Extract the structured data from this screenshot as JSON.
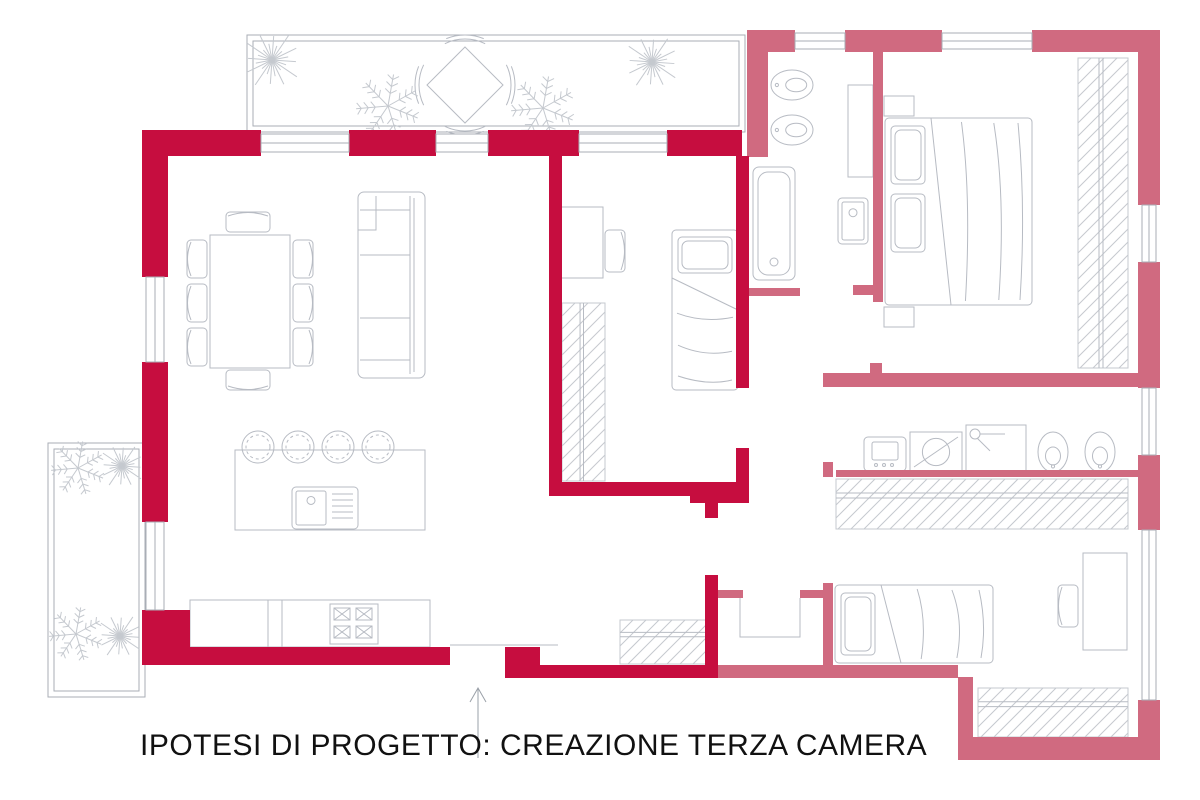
{
  "title": {
    "text": "IPOTESI DI PROGETTO: CREAZIONE TERZA CAMERA"
  },
  "legend": {
    "new_walls_color": "#C60D3F",
    "existing_walls_color": "#D06A80",
    "furniture_line_color": "#B7BBC3",
    "hatch_line_color": "#C5C9CF",
    "terrace_outline_color": "#A9AEB6",
    "entry_arrow_color": "#9AA0A8",
    "new_walls_meaning": "nuove pareti (terza camera)",
    "existing_walls_meaning": "pareti esistenti"
  },
  "canvas": {
    "width": 1200,
    "height": 800
  },
  "plan": {
    "walls_new": [
      {
        "n": "top-wall-seg-1",
        "x": 142,
        "y": 130,
        "w": 119,
        "h": 26
      },
      {
        "n": "top-wall-seg-2",
        "x": 349,
        "y": 130,
        "w": 87,
        "h": 26
      },
      {
        "n": "top-wall-seg-3",
        "x": 488,
        "y": 130,
        "w": 91,
        "h": 26
      },
      {
        "n": "top-wall-seg-4",
        "x": 667,
        "y": 130,
        "w": 75,
        "h": 26
      },
      {
        "n": "left-wall-seg-1",
        "x": 142,
        "y": 156,
        "w": 26,
        "h": 121
      },
      {
        "n": "left-wall-seg-2",
        "x": 142,
        "y": 362,
        "w": 26,
        "h": 160
      },
      {
        "n": "left-wall-corner",
        "x": 142,
        "y": 610,
        "w": 48,
        "h": 55
      },
      {
        "n": "bottom-wall-west",
        "x": 142,
        "y": 647,
        "w": 308,
        "h": 18
      },
      {
        "n": "entry-step",
        "x": 505,
        "y": 647,
        "w": 35,
        "h": 18
      },
      {
        "n": "bottom-wall-east",
        "x": 505,
        "y": 665,
        "w": 212,
        "h": 13
      },
      {
        "n": "new-bedroom-west-wall",
        "x": 549,
        "y": 156,
        "w": 13,
        "h": 326
      },
      {
        "n": "new-bedroom-south-wall",
        "x": 549,
        "y": 482,
        "w": 200,
        "h": 14
      },
      {
        "n": "new-bedroom-south-corner",
        "x": 690,
        "y": 482,
        "w": 59,
        "h": 21
      },
      {
        "n": "new-bedroom-east-wall-upper",
        "x": 736,
        "y": 156,
        "w": 13,
        "h": 232
      },
      {
        "n": "new-bedroom-east-wall-lower",
        "x": 736,
        "y": 448,
        "w": 13,
        "h": 34
      },
      {
        "n": "hall-wall-upper",
        "x": 705,
        "y": 495,
        "w": 13,
        "h": 23
      },
      {
        "n": "hall-wall-lower",
        "x": 705,
        "y": 575,
        "w": 13,
        "h": 103
      }
    ],
    "walls_existing": [
      {
        "n": "wing-top-seg-1",
        "x": 747,
        "y": 30,
        "w": 48,
        "h": 22
      },
      {
        "n": "wing-top-seg-2",
        "x": 845,
        "y": 30,
        "w": 97,
        "h": 22
      },
      {
        "n": "wing-top-seg-3",
        "x": 1032,
        "y": 30,
        "w": 128,
        "h": 22
      },
      {
        "n": "wing-west-wall",
        "x": 747,
        "y": 52,
        "w": 21,
        "h": 105
      },
      {
        "n": "wing-east-seg-1",
        "x": 1138,
        "y": 30,
        "w": 22,
        "h": 175
      },
      {
        "n": "wing-east-seg-2",
        "x": 1138,
        "y": 262,
        "w": 22,
        "h": 126
      },
      {
        "n": "wing-east-seg-3",
        "x": 1138,
        "y": 455,
        "w": 22,
        "h": 75
      },
      {
        "n": "wing-east-seg-4",
        "x": 1138,
        "y": 700,
        "w": 22,
        "h": 60
      },
      {
        "n": "wing-south-wall",
        "x": 958,
        "y": 737,
        "w": 202,
        "h": 23
      },
      {
        "n": "wing-south-step",
        "x": 958,
        "y": 677,
        "w": 15,
        "h": 60
      },
      {
        "n": "bedroom2-south-wall",
        "x": 717,
        "y": 665,
        "w": 241,
        "h": 13
      },
      {
        "n": "master-partition",
        "x": 873,
        "y": 52,
        "w": 10,
        "h": 250
      },
      {
        "n": "master-partition-stub",
        "x": 853,
        "y": 285,
        "w": 20,
        "h": 10
      },
      {
        "n": "corridor-tick",
        "x": 870,
        "y": 363,
        "w": 12,
        "h": 12
      },
      {
        "n": "bath2-north-wall",
        "x": 823,
        "y": 373,
        "w": 315,
        "h": 14
      },
      {
        "n": "bath2-door-stub",
        "x": 823,
        "y": 462,
        "w": 10,
        "h": 15
      },
      {
        "n": "bath2-south-wall",
        "x": 836,
        "y": 470,
        "w": 302,
        "h": 7
      },
      {
        "n": "bath1-south-wall",
        "x": 748,
        "y": 288,
        "w": 52,
        "h": 8
      },
      {
        "n": "niche-stub-west",
        "x": 717,
        "y": 590,
        "w": 26,
        "h": 8
      },
      {
        "n": "niche-stub-east",
        "x": 800,
        "y": 590,
        "w": 28,
        "h": 8
      },
      {
        "n": "bedroom2-west-wall",
        "x": 823,
        "y": 583,
        "w": 10,
        "h": 94
      }
    ],
    "windows": [
      {
        "n": "window-top-1",
        "x": 261,
        "y": 134,
        "w": 88,
        "h": 18
      },
      {
        "n": "window-top-2",
        "x": 436,
        "y": 134,
        "w": 52,
        "h": 18
      },
      {
        "n": "window-top-3",
        "x": 579,
        "y": 134,
        "w": 88,
        "h": 18
      },
      {
        "n": "window-wing-top-1",
        "x": 795,
        "y": 33,
        "w": 50,
        "h": 16
      },
      {
        "n": "window-wing-top-2",
        "x": 942,
        "y": 33,
        "w": 90,
        "h": 16
      },
      {
        "n": "window-left-1",
        "x": 146,
        "y": 277,
        "w": 18,
        "h": 85
      },
      {
        "n": "window-left-2",
        "x": 146,
        "y": 522,
        "w": 18,
        "h": 88
      },
      {
        "n": "window-east-1",
        "x": 1142,
        "y": 205,
        "w": 14,
        "h": 57
      },
      {
        "n": "window-east-2",
        "x": 1142,
        "y": 388,
        "w": 14,
        "h": 67
      },
      {
        "n": "window-east-3",
        "x": 1142,
        "y": 530,
        "w": 14,
        "h": 170
      }
    ],
    "terraces": [
      {
        "n": "terrace-north-outer",
        "x": 247,
        "y": 35,
        "w": 498,
        "h": 97
      },
      {
        "n": "terrace-north-inner",
        "x": 253,
        "y": 41,
        "w": 486,
        "h": 85
      },
      {
        "n": "terrace-west-outer",
        "x": 48,
        "y": 443,
        "w": 97,
        "h": 254
      },
      {
        "n": "terrace-west-inner",
        "x": 54,
        "y": 449,
        "w": 85,
        "h": 242
      }
    ],
    "wardrobes": [
      {
        "n": "wardrobe-new-bedroom",
        "x": 562,
        "y": 303,
        "w": 43,
        "h": 178,
        "rails": "v"
      },
      {
        "n": "wardrobe-entry",
        "x": 620,
        "y": 620,
        "w": 90,
        "h": 44,
        "rails": "h"
      },
      {
        "n": "wardrobe-bedroom2",
        "x": 836,
        "y": 479,
        "w": 292,
        "h": 50,
        "rails": "h"
      },
      {
        "n": "closet-south-east",
        "x": 978,
        "y": 688,
        "w": 150,
        "h": 49,
        "rails": "h"
      },
      {
        "n": "wardrobe-master",
        "x": 1078,
        "y": 58,
        "w": 50,
        "h": 310,
        "rails": "v"
      }
    ],
    "furniture": [
      {
        "k": "box",
        "n": "dining-table",
        "x": 210,
        "y": 235,
        "w": 80,
        "h": 133
      },
      {
        "k": "chair",
        "n": "dining-chair",
        "x": 187,
        "y": 240,
        "w": 20,
        "h": 38,
        "s": "l"
      },
      {
        "k": "chair",
        "n": "dining-chair",
        "x": 187,
        "y": 284,
        "w": 20,
        "h": 38,
        "s": "l"
      },
      {
        "k": "chair",
        "n": "dining-chair",
        "x": 187,
        "y": 328,
        "w": 20,
        "h": 38,
        "s": "l"
      },
      {
        "k": "chair",
        "n": "dining-chair",
        "x": 293,
        "y": 240,
        "w": 20,
        "h": 38,
        "s": "r"
      },
      {
        "k": "chair",
        "n": "dining-chair",
        "x": 293,
        "y": 284,
        "w": 20,
        "h": 38,
        "s": "r"
      },
      {
        "k": "chair",
        "n": "dining-chair",
        "x": 293,
        "y": 328,
        "w": 20,
        "h": 38,
        "s": "r"
      },
      {
        "k": "chair",
        "n": "dining-chair",
        "x": 226,
        "y": 212,
        "w": 44,
        "h": 20,
        "s": "t"
      },
      {
        "k": "chair",
        "n": "dining-chair",
        "x": 226,
        "y": 370,
        "w": 44,
        "h": 20,
        "s": "b"
      },
      {
        "k": "box",
        "n": "sofa",
        "x": 358,
        "y": 192,
        "w": 67,
        "h": 186,
        "rx": 6
      },
      {
        "k": "ln",
        "n": "sofa-back",
        "x1": 410,
        "y1": 196,
        "x2": 410,
        "y2": 374
      },
      {
        "k": "ln",
        "n": "sofa-back",
        "x1": 414,
        "y1": 198,
        "x2": 414,
        "y2": 372
      },
      {
        "k": "ln",
        "n": "sofa-seat-line",
        "x1": 360,
        "y1": 255,
        "x2": 410,
        "y2": 255
      },
      {
        "k": "ln",
        "n": "sofa-seat-line",
        "x1": 360,
        "y1": 318,
        "x2": 410,
        "y2": 318
      },
      {
        "k": "ln",
        "n": "sofa-armrest",
        "x1": 360,
        "y1": 210,
        "x2": 410,
        "y2": 210
      },
      {
        "k": "ln",
        "n": "sofa-armrest",
        "x1": 360,
        "y1": 360,
        "x2": 410,
        "y2": 360
      },
      {
        "k": "path",
        "n": "sofa-chaise",
        "d": "M358,230 L376,230 L376,196"
      },
      {
        "k": "box",
        "n": "kitchen-island",
        "x": 235,
        "y": 450,
        "w": 190,
        "h": 80
      },
      {
        "k": "sink",
        "n": "island-sink",
        "x": 292,
        "y": 487,
        "w": 66,
        "h": 42
      },
      {
        "k": "stool",
        "n": "bar-stool",
        "cx": 258,
        "cy": 447
      },
      {
        "k": "stool",
        "n": "bar-stool",
        "cx": 298,
        "cy": 447
      },
      {
        "k": "stool",
        "n": "bar-stool",
        "cx": 338,
        "cy": 447
      },
      {
        "k": "stool",
        "n": "bar-stool",
        "cx": 378,
        "cy": 447
      },
      {
        "k": "box",
        "n": "kitchen-counter",
        "x": 190,
        "y": 600,
        "w": 240,
        "h": 47
      },
      {
        "k": "ln",
        "n": "counter-division",
        "x1": 268,
        "y1": 600,
        "x2": 268,
        "y2": 647
      },
      {
        "k": "ln",
        "n": "counter-division",
        "x1": 282,
        "y1": 600,
        "x2": 282,
        "y2": 647
      },
      {
        "k": "stove",
        "n": "stove",
        "x": 330,
        "y": 604,
        "w": 48,
        "h": 40
      },
      {
        "k": "tbl45",
        "n": "terrace-table",
        "cx": 465,
        "cy": 85,
        "r": 38
      },
      {
        "k": "plant",
        "n": "plant",
        "cx": 272,
        "cy": 60,
        "r": 30,
        "v": "star"
      },
      {
        "k": "plant",
        "n": "plant",
        "cx": 652,
        "cy": 62,
        "r": 28,
        "v": "star"
      },
      {
        "k": "plant",
        "n": "plant",
        "cx": 388,
        "cy": 106,
        "r": 32,
        "v": "fern"
      },
      {
        "k": "plant",
        "n": "plant",
        "cx": 543,
        "cy": 108,
        "r": 32,
        "v": "fern"
      },
      {
        "k": "plant",
        "n": "plant",
        "cx": 78,
        "cy": 468,
        "r": 27,
        "v": "fern"
      },
      {
        "k": "plant",
        "n": "plant",
        "cx": 122,
        "cy": 466,
        "r": 23,
        "v": "star"
      },
      {
        "k": "plant",
        "n": "plant",
        "cx": 76,
        "cy": 634,
        "r": 27,
        "v": "fern"
      },
      {
        "k": "plant",
        "n": "plant",
        "cx": 120,
        "cy": 636,
        "r": 23,
        "v": "star"
      },
      {
        "k": "box",
        "n": "desk-new-bedroom",
        "x": 558,
        "y": 207,
        "w": 45,
        "h": 71
      },
      {
        "k": "chair",
        "n": "desk-chair",
        "x": 605,
        "y": 230,
        "w": 20,
        "h": 42,
        "s": "r"
      },
      {
        "k": "bed",
        "n": "single-bed-new-bedroom",
        "x": 672,
        "y": 230,
        "w": 66,
        "h": 160,
        "p": 1,
        "dir": "v"
      },
      {
        "k": "bed",
        "n": "double-bed-master",
        "x": 885,
        "y": 118,
        "w": 147,
        "h": 187,
        "p": 2,
        "dir": "h"
      },
      {
        "k": "box",
        "n": "nightstand",
        "x": 884,
        "y": 96,
        "w": 30,
        "h": 20
      },
      {
        "k": "box",
        "n": "nightstand",
        "x": 884,
        "y": 307,
        "w": 30,
        "h": 20
      },
      {
        "k": "box",
        "n": "bath-cabinet",
        "x": 848,
        "y": 85,
        "w": 25,
        "h": 92
      },
      {
        "k": "tub",
        "n": "bathtub",
        "x": 753,
        "y": 167,
        "w": 42,
        "h": 113
      },
      {
        "k": "wc",
        "n": "toilet-bath1",
        "cx": 792,
        "cy": 85,
        "rx": 21,
        "ry": 15,
        "dir": "h"
      },
      {
        "k": "wc",
        "n": "bidet-bath1",
        "cx": 792,
        "cy": 130,
        "rx": 21,
        "ry": 15,
        "dir": "h"
      },
      {
        "k": "sink",
        "n": "sink-bath1",
        "x": 838,
        "y": 198,
        "w": 30,
        "h": 46
      },
      {
        "k": "wm",
        "n": "washing-machine",
        "x": 864,
        "y": 437,
        "w": 42,
        "h": 34,
        "v": "wm"
      },
      {
        "k": "wm",
        "n": "dryer",
        "x": 910,
        "y": 432,
        "w": 52,
        "h": 40,
        "v": "dry"
      },
      {
        "k": "wm",
        "n": "shower",
        "x": 966,
        "y": 425,
        "w": 60,
        "h": 47,
        "v": "shw"
      },
      {
        "k": "wc",
        "n": "toilet-bath2",
        "cx": 1053,
        "cy": 452,
        "rx": 15,
        "ry": 20,
        "dir": "v"
      },
      {
        "k": "wc",
        "n": "bidet-bath2",
        "cx": 1100,
        "cy": 452,
        "rx": 15,
        "ry": 20,
        "dir": "v"
      },
      {
        "k": "bed",
        "n": "single-bed-bedroom2",
        "x": 835,
        "y": 585,
        "w": 158,
        "h": 78,
        "p": 1,
        "dir": "h"
      },
      {
        "k": "box",
        "n": "desk-bedroom2",
        "x": 1083,
        "y": 553,
        "w": 44,
        "h": 97
      },
      {
        "k": "chair",
        "n": "desk-chair",
        "x": 1058,
        "y": 585,
        "w": 20,
        "h": 42,
        "s": "l"
      },
      {
        "k": "path",
        "n": "storage-niche",
        "d": "M740,598 L740,637 L800,637 L800,598"
      },
      {
        "k": "ln",
        "n": "entry-door-header",
        "x1": 450,
        "y1": 645,
        "x2": 558,
        "y2": 645
      }
    ],
    "entry_arrow": {
      "n": "entrance-arrow",
      "x": 478,
      "y_tail": 758,
      "y_head": 688
    }
  }
}
